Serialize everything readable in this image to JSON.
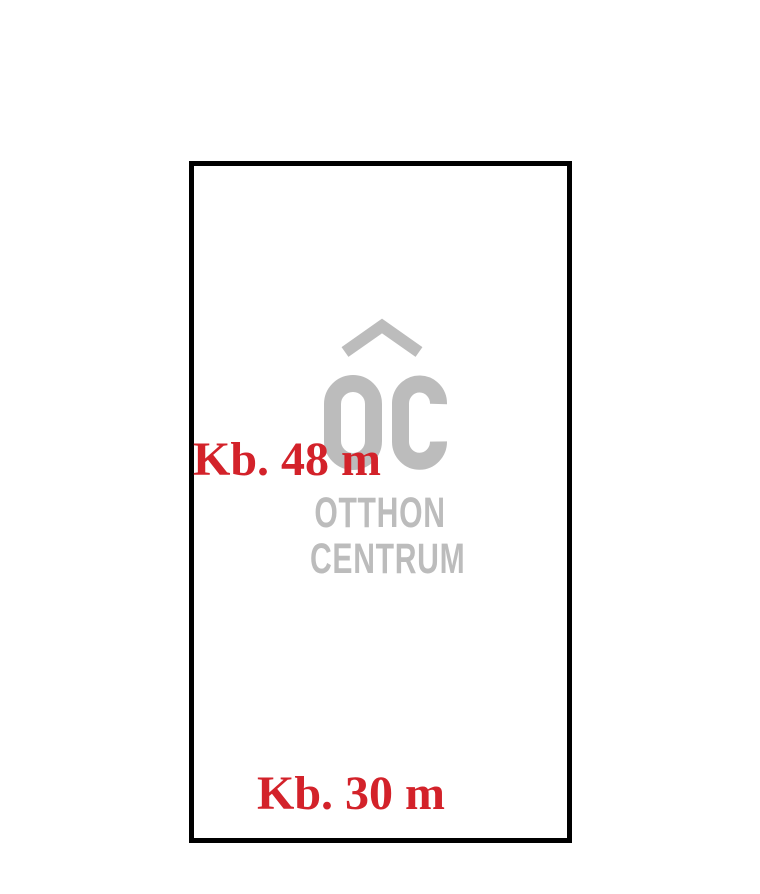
{
  "diagram": {
    "type": "property-plot-sketch",
    "outline": {
      "side_length_label": "Kb. 48 m",
      "bottom_length_label": "Kb. 30 m"
    },
    "watermark": {
      "brand_line1": "OTTHON",
      "brand_line2": "CENTRUM",
      "logo_icon": "oc-monogram-with-roof"
    },
    "colors": {
      "dimension_red": "#d3222a",
      "logo_gray": "#bcbcbc",
      "outline_black": "#000000",
      "background": "#ffffff"
    }
  }
}
